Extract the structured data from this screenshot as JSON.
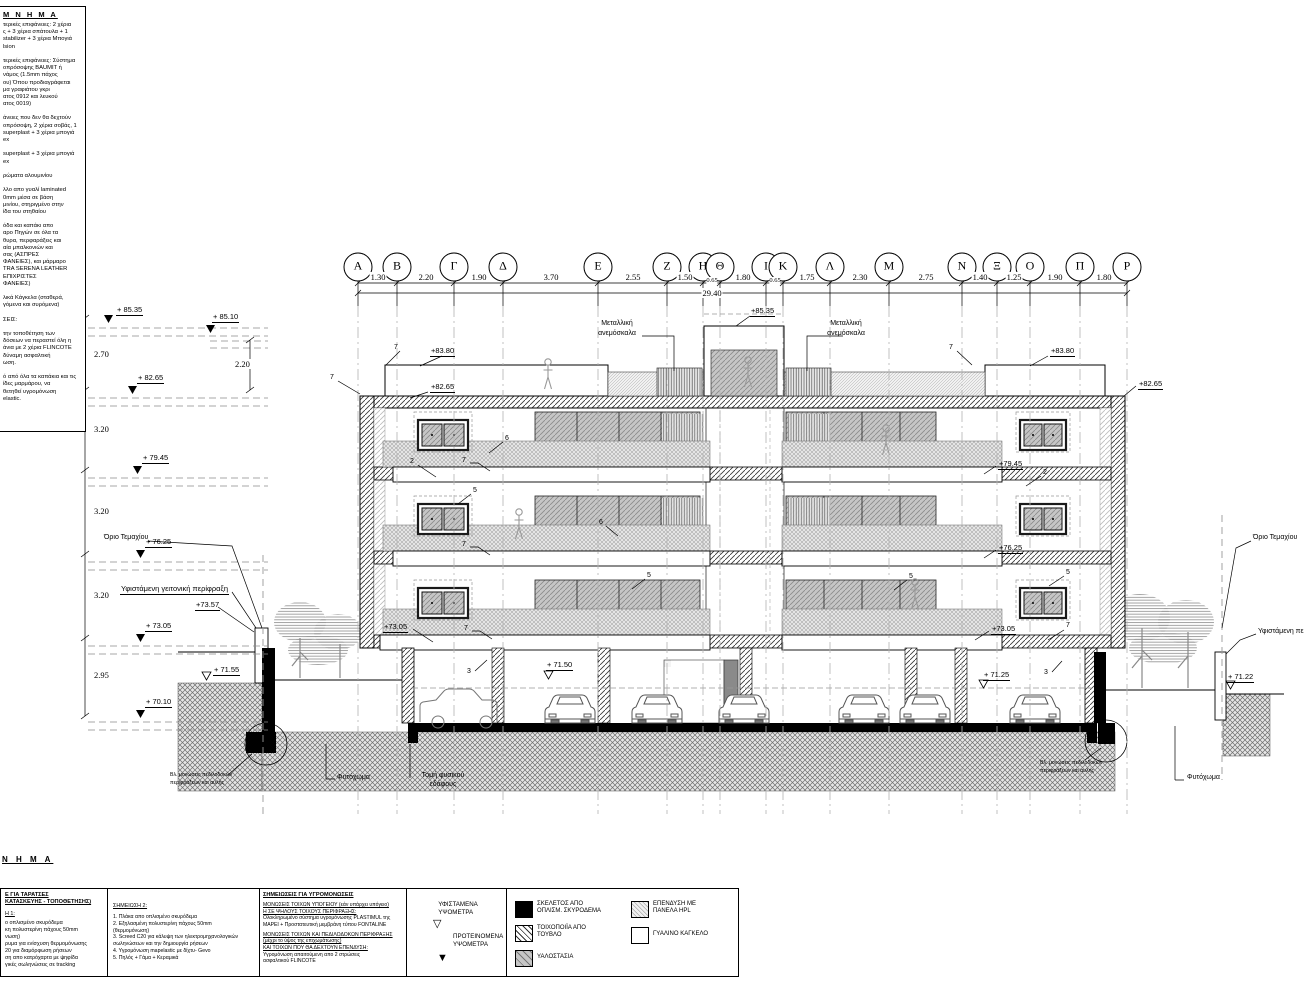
{
  "colors": {
    "ink": "#000000",
    "hatch": "#555555",
    "glass": "#c6c6c6",
    "earth": "#e6e6e6"
  },
  "legend_topleft": {
    "header": "Μ Ν Η Μ Α",
    "body": "τερικές επιφάνειες: 2 χέρια\nς + 3 χέρια σπάτουλα + 1\nstabilizer + 3 χέρια Μπογιά\nlsion\n\nτερικές επιφάνειες: Σύστημα\nοπρόσοψης BAUMIT ή\nνάμος (1.5mm πάχος\nου) Όπου προδιαγράφεται\nμα γραφιάτου γκρι\nατος 0912 και λευκού\nατος 0019)\n\nάνειες που δεν θα δεχτούν\nοπρόσοψη, 2 χέρια σοβάς, 1\nsuperplast + 3 χέρια μπογιά\nex\n\nsuperplast + 3 χέρια μπογιά\nex\n\nρώματα αλουμινίου\n\nλλο απο γυαλί laminated\n0mm μέσα σε βάση\nμινίου, στηριγμένο στην\nίδα του στηθαίου\n\nόδα και καπάκι απο\nαρο Πηγών σε όλα τα\nθυρα, περφαράξεις και\nαία μπαλκονιών και\nσας (ΑΣΠΡΕΣ\nΦΑΝΕΙΕΣ), και μάρμαρο\nTRA SERENA LEATHER\nΕΠΙΧΡΙΣΤΕΣ\nΦΑΝΕΙΕΣ)\n\nλικά Κάγκελα (σταθερά,\nγόμενα και συρόμενα)\n\nΣΕΙΣ:\n\nτην τοποθέτηση των\nδόσεων να περαστεί όλη η\nάνια με 2 χέρια FLINCOTE\nδύναμη ασφαλτική\nωση.\n\nό από όλα τα καπάκια και τις\nίδες μαρμάρου, να\nθετηθεί υγρομόνωση\nelastic."
  },
  "grid": {
    "axes": [
      "Α",
      "Β",
      "Γ",
      "Δ",
      "Ε",
      "Ζ",
      "Η",
      "Θ",
      "Ι",
      "Κ",
      "Λ",
      "Μ",
      "Ν",
      "Ξ",
      "Ο",
      "Π",
      "Ρ"
    ],
    "dims": [
      "1.30",
      "2.20",
      "1.90",
      "3.70",
      "2.55",
      "1.50",
      "0.65",
      "1.80",
      "0.65",
      "1.75",
      "2.30",
      "2.75",
      "1.40",
      "1.25",
      "1.90",
      "1.80"
    ],
    "total": "29.40"
  },
  "levels": {
    "l8535": "+ 85.35",
    "l8510": "+ 85.10",
    "l8265": "+ 82.65",
    "l7945": "+ 79.45",
    "l7625": "+ 76.25",
    "l7305": "+ 73.05",
    "l7010": "+ 70.10",
    "d270": "2.70",
    "d220": "2.20",
    "d320": "3.20",
    "d295": "2.95",
    "top8535": "+85.35",
    "r8380": "+83.80",
    "r8265": "+82.65",
    "r7945": "+79.45",
    "r7625": "+76.25",
    "r7305": "+73.05",
    "l7357": "+73.57",
    "l7155": "+ 71.55",
    "b7150": "+ 71.50",
    "r7125": "+ 71.25",
    "r7122": "+ 71.22"
  },
  "ann": {
    "orio": "Όριο Τεμαχίου",
    "fence": "Υφιστάμενη γειτονική περίφραξη",
    "fence_r": "Υφιστάμενη πε",
    "ladder1": "Μεταλλική",
    "ladder2": "ανεμόσκαλα",
    "fyto": "Φυτόχωμα",
    "tomi1": "Τομή φυσικού",
    "tomi2": "εδάφους",
    "vl1": "Βλ. μονώσεις πεδιλοδοκών",
    "vl2": "περιφράξεων και αυλής",
    "n1": "1",
    "n2": "2",
    "n3": "3",
    "n5": "5",
    "n6": "6",
    "n7": "7"
  },
  "notes": {
    "header": "Ν Η Μ Α",
    "b1_t1": "Ε ΓΙΑ ΤΑΡΑΤΣΕΣ",
    "b1_t2": "ΚΑΤΑΣΚΕΥΗΣ - ΤΟΠΟΘΕΤΗΣΗΣ)",
    "b1_sub": "Η 1:",
    "b1_body": "ο οπλισμένο σκυρόδεμα\nκη πολυστερίνη πάχους 50mm\nνωση)\nρυμα για ενίσχυση θερμομόνωσης\n20 για διαμόρφωση ρήσεων\nση απο κατρόχαρτα με ψηφίδα\nγικές σωληνώσεις σε tracking",
    "b2_t": "ΣΗΜΕΙΩΣΗ 2:",
    "b2_body": "1. Πλάκα απο οπλισμένο σκυρόδεμα\n2. Εξηλασμένη πολυστερίνη πάχους 50mm\n    (θερμομόνωση)\n3. Screed C20 για κάλυψη των ηλεκτρομηχανολογικών\n    σωληνώσεων και την δημιουργία ρήσεων\n4. Υγρομόνωση mapelastic με δίχτυ- Gevo\n5. Πηλός + Γάμα + Κεραμικά",
    "b3_t": "ΣΗΜΕΙΩΣΕΙΣ ΓΙΑ ΥΓΡΟΜΟΝΩΣΕΙΣ",
    "b3_s1": "ΜΟΝΩΣΕΙΣ ΤΟΙΧΩΝ ΥΠΟΓΕΙΟΥ (εάν υπάρχει υπόγειο)\nΗ ΣΕ ΨΗΛΟΥΣ ΤΟΙΧΟΥΣ ΠΕΡΙΦΡΑΞΗΣ:",
    "b3_b1": "Ολοκληρωμένο σύστημα υγρομόνωσης PLASTIMUL της\nMAPEI + Προστατευτική μεμβράνη τύπου FONTALINE",
    "b3_s2": "ΜΟΝΩΣΕΙΣ ΤΟΙΧΩΝ ΚΑΙ ΠΕΔΙΛΟΔΟΚΩΝ ΠΕΡΙΦΡΑΞΗΣ\n(μέχρι το ύψος της επιχωμάτωσης)\nΚΑΙ ΤΟΙΧΩΝ ΠΟΥ ΘΑ ΔΕΧΤΟΥΝ ΕΠΕΝΔΥΣΗ:",
    "b3_b2": "Υγρομόνωση απαιτούμενη απο 2 στρώσεις\nασφαλτικού FLINCOTE"
  },
  "levels_key": {
    "existing": "ΥΦΙΣΤΑΜΕΝΑ\nΥΨΟΜΕΤΡΑ",
    "proposed": "ΠΡΟΤΕΙΝΟΜΕΝΑ\nΥΨΟΜΕΤΡΑ",
    "existing_sym": "▽",
    "proposed_sym": "▼"
  },
  "hatch_legend": {
    "concrete": "ΣΚΕΛΕΤΟΣ ΑΠΟ\nΟΠΛΙΣΜ. ΣΚΥΡΟΔΕΜΑ",
    "brick": "ΤΟΙΧΟΠΟΙΪΑ ΑΠΟ\nΤΟΥΒΛΟ",
    "glazing": "ΥΑΛΟΣΤΑΣΙΑ",
    "hpl": "ΕΠΕΝΔΥΣΗ ΜΕ\nΠΑΝΕΛΑ HPL",
    "glassrail": "ΓΥΑΛΙΝΟ ΚΑΓΚΕΛΟ"
  }
}
